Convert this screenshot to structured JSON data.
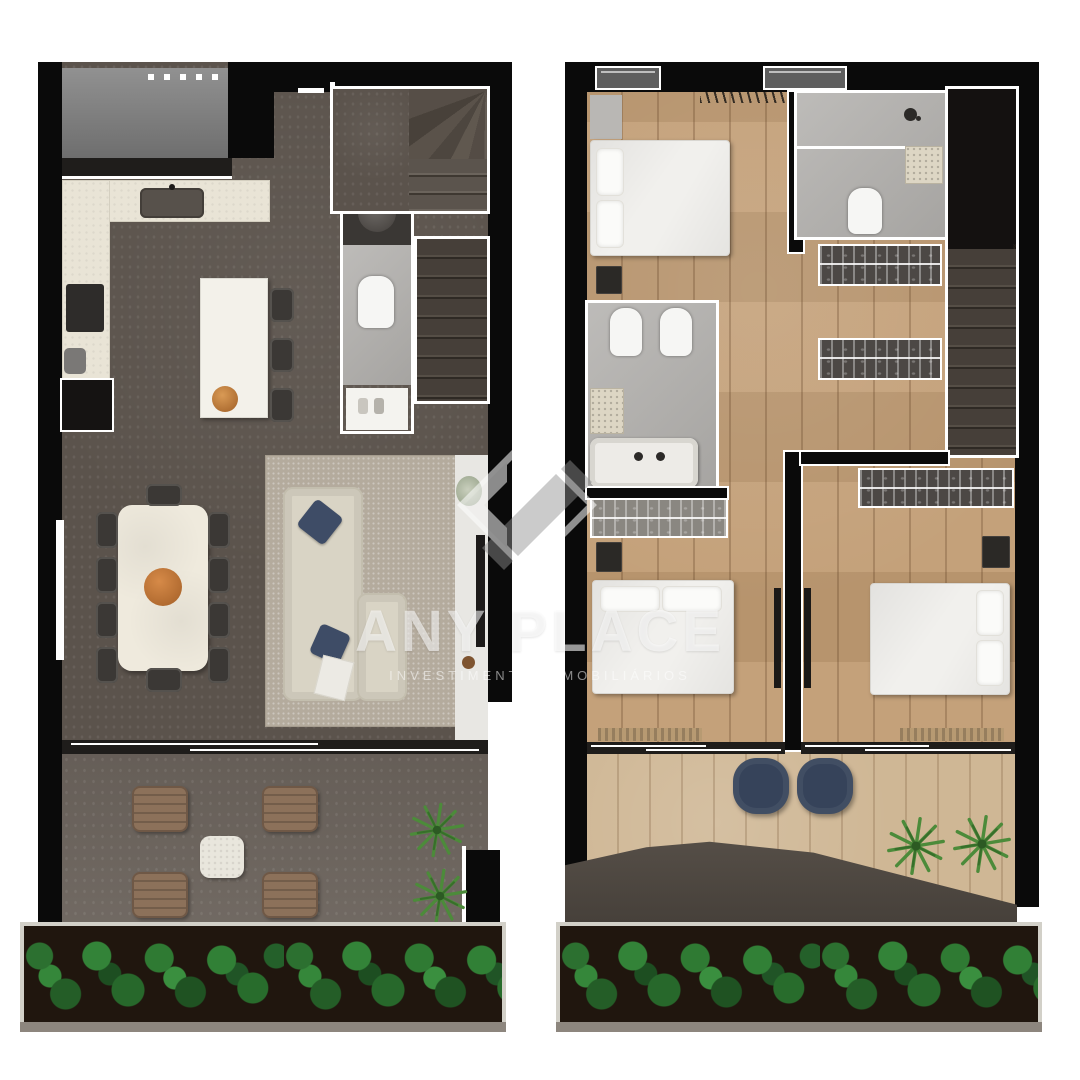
{
  "watermark": {
    "brand": "ANY PLACE",
    "subtitle": "INVESTIMENTOS IMOBILIÁRIOS"
  },
  "palette": {
    "wall": "#0a0a0a",
    "outline": "#ffffff",
    "floor1": "#5b534c",
    "terrace": "#6b635c",
    "floor2_wood": "#c19c73",
    "balcony_wood": "#cfb795",
    "rug": "#b4ab9d",
    "kitchen_counter": "#e9e4d6",
    "marble_table": "#efeadd",
    "sofa_beige": "#d9d4c5",
    "pillow_navy": "#3e4c66",
    "pouf_navy": "#36435a",
    "terrace_chair_brown": "#8c715a",
    "decor_orange": "#c0763b",
    "bath_tile": "#b4b2af",
    "plant_green": "#2f7a33",
    "planter_soil": "#20160e"
  },
  "floors": {
    "floor1": {
      "label": "lower floor – kitchen, living, dining, terrace"
    },
    "floor2": {
      "label": "upper floor – bedrooms, bathrooms, balcony"
    }
  }
}
